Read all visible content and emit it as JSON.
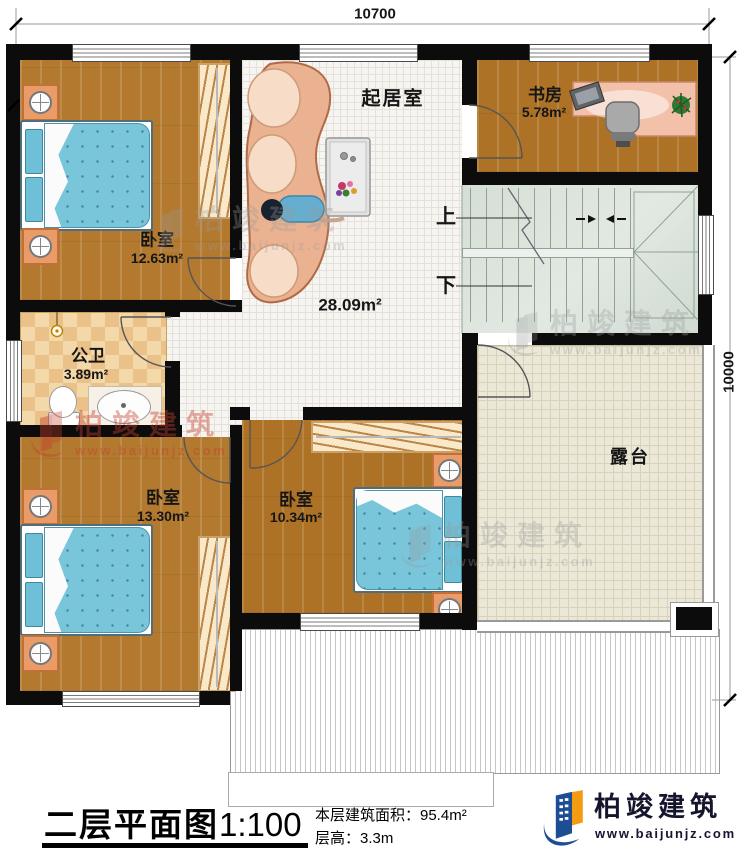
{
  "dimensions": {
    "top": "10700",
    "right": "10000"
  },
  "rooms": {
    "bedroom_top_left": {
      "name": "卧室",
      "area": "12.63m²"
    },
    "living_room": {
      "name": "起居室",
      "area": "28.09m²"
    },
    "study": {
      "name": "书房",
      "area": "5.78m²"
    },
    "bathroom": {
      "name": "公卫",
      "area": "3.89m²"
    },
    "bedroom_bottom_left": {
      "name": "卧室",
      "area": "13.30m²"
    },
    "bedroom_bottom_mid": {
      "name": "卧室",
      "area": "10.34m²"
    },
    "terrace": {
      "name": "露台"
    }
  },
  "stairs": {
    "up_label": "上",
    "down_label": "下"
  },
  "footer": {
    "title": "二层平面图",
    "scale": "1:100",
    "floor_area": "本层建筑面积：95.4m²",
    "floor_height": "层高：3.3m"
  },
  "brand": {
    "name": "柏竣建筑",
    "website": "www.baijunjz.com"
  },
  "watermark": {
    "name": "柏竣建筑",
    "website": "www.baijunjz.com"
  },
  "colors": {
    "brand_blue": "#1d4e94",
    "brand_orange": "#f39c12",
    "watermark_red": "#c4402e",
    "wall": "#0c0c0c"
  }
}
